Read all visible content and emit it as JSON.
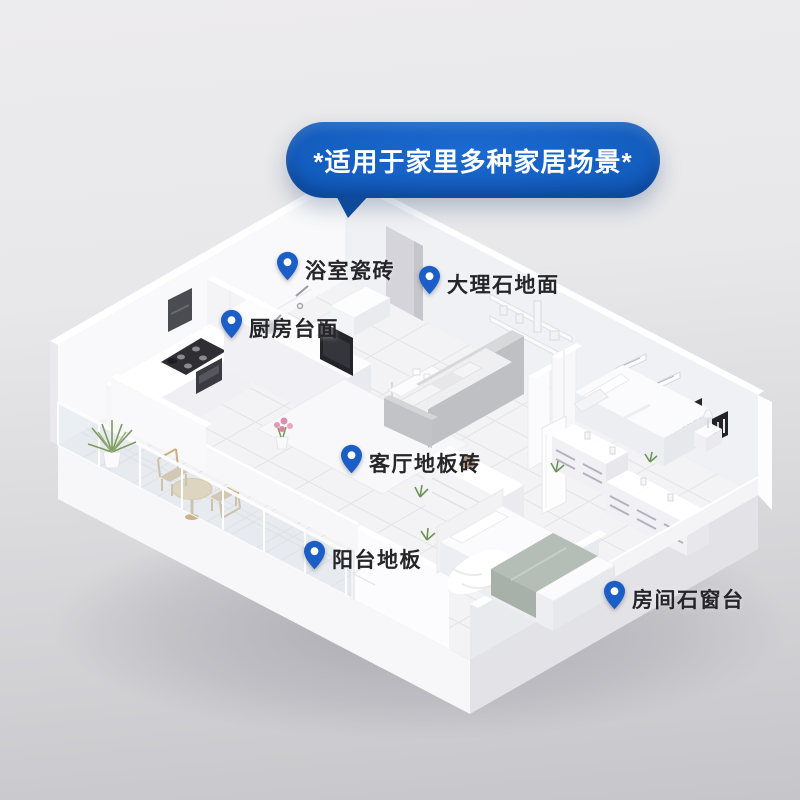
{
  "banner": {
    "text": "*适用于家里多种家居场景*"
  },
  "pins": [
    {
      "id": "bathroom-tiles",
      "label": "浴室瓷砖",
      "x": 277,
      "y": 251
    },
    {
      "id": "marble-floor",
      "label": "大理石地面",
      "x": 419,
      "y": 265
    },
    {
      "id": "kitchen-countertop",
      "label": "厨房台面",
      "x": 221,
      "y": 309
    },
    {
      "id": "living-room-floor-tiles",
      "label": "客厅地板砖",
      "x": 341,
      "y": 444
    },
    {
      "id": "balcony-floor",
      "label": "阳台地板",
      "x": 304,
      "y": 540
    },
    {
      "id": "room-stone-windowsill",
      "label": "房间石窗台",
      "x": 604,
      "y": 580
    }
  ],
  "colors": {
    "pin_blue": "#1a5ec6",
    "banner_blue_center": "#1b6ad2",
    "banner_blue_edge": "#0c4da5",
    "banner_text": "#ffffff",
    "label_text": "#26262a",
    "background_top": "#ebebed",
    "background_bottom": "#c7c7cb"
  }
}
